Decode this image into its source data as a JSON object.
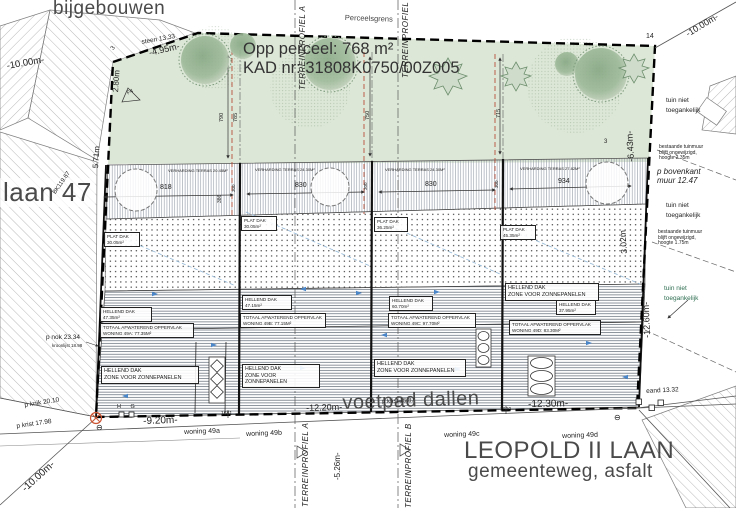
{
  "colors": {
    "garden_green": "#dde7d7",
    "tree_green": "#8fae8c",
    "roof_hatch": "#4f5a66",
    "boundary_black": "#000000",
    "accent_red_dashed": "#b5503a",
    "accent_blue_arrow": "#4a86c8",
    "label_gray": "#4a4a4a",
    "note_green": "#2e6e52"
  },
  "titles": {
    "bijgebouwen": "bijgebouwen",
    "laan47": "laan 47",
    "voetpad": "voetpad dallen",
    "leopold": "LEOPOLD II LAAN",
    "gemeenteweg": "gemeenteweg, asfalt",
    "opp": "Opp perceel: 768 m²",
    "kad": "KAD nr: 31808K0750/00Z005",
    "perceelsgrens": "Perceelsgrens"
  },
  "dims": {
    "d1000": "-10.00m-",
    "d495": "-4.95m-",
    "d280": "2.80m",
    "d571": "5.71m",
    "d643": "-6.43m-",
    "d302": "3.02m",
    "d1260": "-12.60m-",
    "d920": "-9.20m-",
    "d1220": "-12.20m-",
    "d1230": "-12.30m-",
    "d526": "-5.26m-"
  },
  "survey": {
    "steen": "steen 13.33",
    "bk": "BK119.67",
    "pnok": "p nok 23.34",
    "kroonlijst": "kroonlijst 18.98",
    "pknik": "p knik 20.10",
    "pkrist1": "p krist 17.98",
    "pkrist2": "p krist 15.87",
    "eand": "eand 13.32",
    "hg": "H G",
    "n1681": "1681",
    "n1690": "1690",
    "n14": "14",
    "n3": "3",
    "f4": "F4",
    "minus": "⊖"
  },
  "sections": {
    "a": "TERREINPROFIEL A",
    "b": "TERREINPROFIEL B"
  },
  "right_notes": {
    "tuin": "tuin niet\ntoegankelijk",
    "muur1": "bestaande tuinmuur\nblijft ongewijzigd,\nhoogte 2.35m",
    "muur2": "bestaande tuinmuur\nblijft ongewijzigd,\nhoogte 1.75m",
    "bovenkant": "p bovenkant\nmuur 12.47"
  },
  "garden_dims": [
    "790",
    "785",
    "750",
    "715"
  ],
  "terrace_depths": [
    "386",
    "300",
    "300",
    "300"
  ],
  "terraces": [
    {
      "width": "818",
      "note": "VERHARDING TERRAS 20.45M²"
    },
    {
      "width": "830",
      "note": "VERHARDING TERRAS 24.30M²"
    },
    {
      "width": "830",
      "note": "VERHARDING TERRAS 24.30M²"
    },
    {
      "width": "934",
      "note": "VERHARDING TERRAS 27.82M²"
    }
  ],
  "houses": [
    {
      "woning": "woning 49a",
      "hellend": "HELLEND DAK\n47.35m²",
      "totaal": "TOTAAL AFWATEREND OPPERVLAK\nWONING 49A: 77.35M²",
      "zone": "HELLEND DAK\nZONE VOOR ZONNEPANELEN",
      "plat": "PLAT DAK\n30.05m²"
    },
    {
      "woning": "woning 49b",
      "hellend": "HELLEND DAK\n47.15m²",
      "totaal": "TOTAAL AFWATEREND OPPERVLAK\nWONING 49B: 77.15M²",
      "zone": "HELLEND DAK\nZONE VOOR ZONNEPANELEN",
      "plat": "PLAT DAK\n30.05m²"
    },
    {
      "woning": "woning 49c",
      "hellend": "HELLEND DAK\n60.70m²",
      "totaal": "TOTAAL AFWATEREND OPPERVLAK\nWONING 49C: 97.70M²",
      "zone": "HELLEND DAK\nZONE VOOR ZONNEPANELEN",
      "plat": "PLAT DAK\n36.25m²"
    },
    {
      "woning": "woning 49d",
      "hellend": "HELLEND DAK\n37.95m²",
      "totaal": "TOTAAL AFWATEREND OPPERVLAK\nWONING 49D: 83.30M²",
      "zone": "HELLEND DAK\nZONE VOOR ZONNEPANELEN",
      "plat": "PLAT DAK\n45.35m²"
    }
  ]
}
